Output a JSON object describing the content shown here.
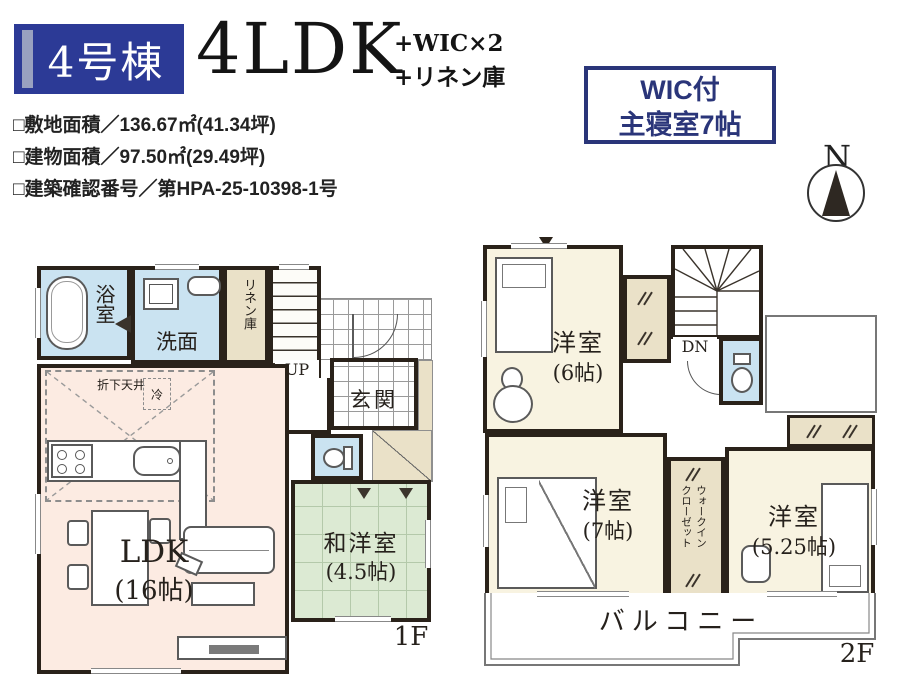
{
  "header": {
    "unit_label": "4号棟",
    "layout": "4LDK",
    "layout_extra1": "+WIC×2",
    "layout_extra2": "+リネン庫",
    "details": [
      "□敷地面積／136.67㎡(41.34坪)",
      "□建物面積／97.50㎡(29.49坪)",
      "□建築確認番号／第HPA-25-10398-1号"
    ],
    "badge_line1": "WIC付",
    "badge_line2": "主寝室7帖",
    "compass_n": "N"
  },
  "floor1": {
    "floor_label": "1F",
    "bath": "浴室",
    "wash": "洗面",
    "linen": "リネン庫",
    "up": "UP",
    "entrance": "玄関",
    "ps": "PS",
    "wic_line1": "ウォークイン",
    "wic_line2": "クローゼット",
    "oridashi": "折下天井",
    "rei": "冷",
    "ldk_name": "LDK",
    "ldk_size": "(16帖)",
    "wayo_name": "和洋室",
    "wayo_size": "(4.5帖)"
  },
  "floor2": {
    "floor_label": "2F",
    "dn": "DN",
    "room6_name": "洋室",
    "room6_size": "(6帖)",
    "room7_name": "洋室",
    "room7_size": "(7帖)",
    "room525_name": "洋室",
    "room525_size": "(5.25帖)",
    "wic_line1": "ウォークイン",
    "wic_line2": "クローゼット",
    "balcony": "バルコニー"
  },
  "colors": {
    "navy": "#2c3a96",
    "badge_navy": "#2a3579",
    "wall": "#2a221a",
    "water_blue": "#cae3f1",
    "closet_beige": "#eae1c8",
    "ldk_pink": "#fcebe2",
    "bedroom_cream": "#f8f3e1",
    "tatami_green": "#dcead3"
  }
}
